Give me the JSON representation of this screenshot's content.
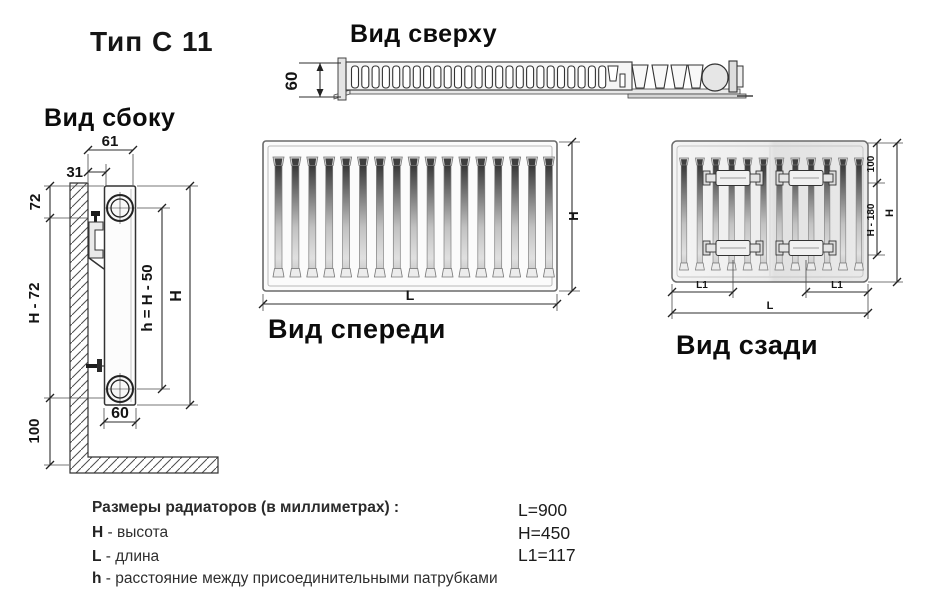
{
  "title": "Тип С 11",
  "views": {
    "top": {
      "label": "Вид сверху",
      "dims": {
        "depth": "60"
      }
    },
    "side": {
      "label": "Вид сбоку",
      "dims": {
        "total_depth": "61",
        "wall_gap": "31",
        "top_offset": "72",
        "mid_height": "H - 72",
        "bottom_clearance": "100",
        "panel_depth": "60",
        "pipe_distance": "h = H - 50",
        "height": "H"
      }
    },
    "front": {
      "label": "Вид спереди",
      "dims": {
        "height": "H",
        "length": "L"
      }
    },
    "back": {
      "label": "Вид сзади",
      "dims": {
        "bracket_top_offset": "100",
        "bracket_span": "H - 180",
        "height": "H",
        "l1_left": "L1",
        "l1_right": "L1",
        "length": "L"
      }
    }
  },
  "legend": {
    "heading": "Размеры радиаторов (в миллиметрах) :",
    "items": [
      {
        "key": "H",
        "desc": "- высота"
      },
      {
        "key": "L",
        "desc": "- длина"
      },
      {
        "key": "h",
        "desc": "- расстояние между присоединительными патрубками"
      }
    ]
  },
  "values": {
    "length": "L=900",
    "height": "H=450",
    "l1": "L1=117"
  }
}
